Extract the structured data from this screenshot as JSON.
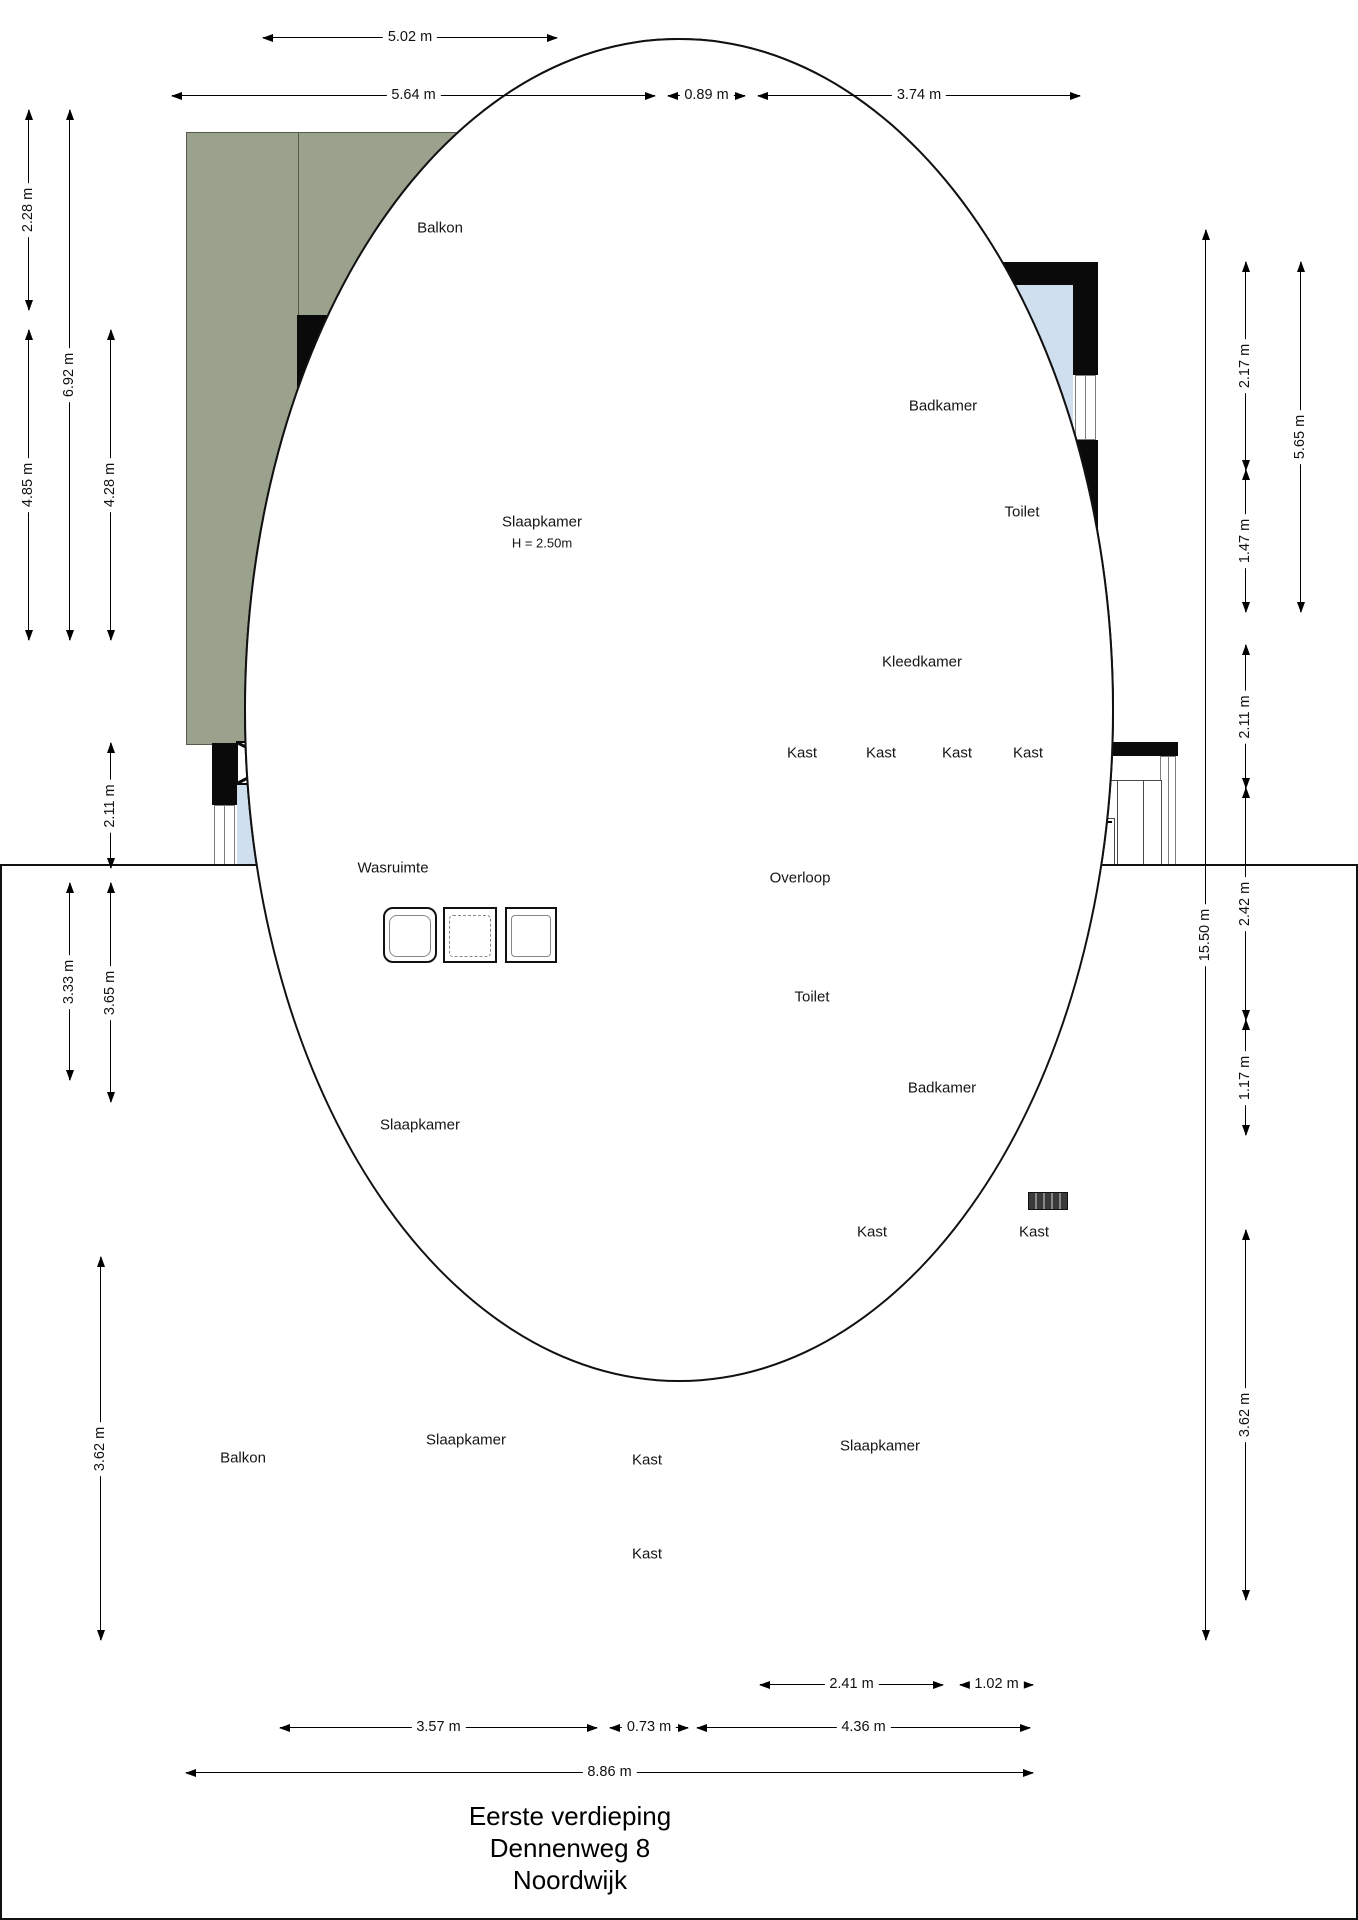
{
  "title": {
    "line1": "Eerste verdieping",
    "line2": "Dennenweg 8",
    "line3": "Noordwijk"
  },
  "rooms": {
    "balkon": "Balkon",
    "slaapkamer": "Slaapkamer",
    "slaapkamer_height": "H = 2.50m",
    "badkamer": "Badkamer",
    "toilet": "Toilet",
    "kleedkamer": "Kleedkamer",
    "kast": "Kast",
    "wasruimte": "Wasruimte",
    "overloop": "Overloop"
  },
  "dims": {
    "top": [
      "5.02 m",
      "5.64 m",
      "0.89 m",
      "3.74 m"
    ],
    "left": [
      "2.28 m",
      "6.92 m",
      "4.85 m",
      "4.28 m",
      "2.11 m",
      "3.33 m",
      "3.65 m",
      "3.62 m"
    ],
    "right": [
      "2.17 m",
      "1.47 m",
      "5.65 m",
      "2.11 m",
      "15.50 m",
      "2.42 m",
      "1.17 m",
      "3.62 m"
    ],
    "bottom": [
      "2.41 m",
      "1.02 m",
      "3.57 m",
      "0.73 m",
      "4.36 m",
      "8.86 m"
    ]
  },
  "colors": {
    "wall": "#0a0a0a",
    "room_orange": "#f3c17c",
    "room_tan": "#d7af80",
    "room_blue": "#cfdfee",
    "balcony_grey": "#9aa18d"
  }
}
